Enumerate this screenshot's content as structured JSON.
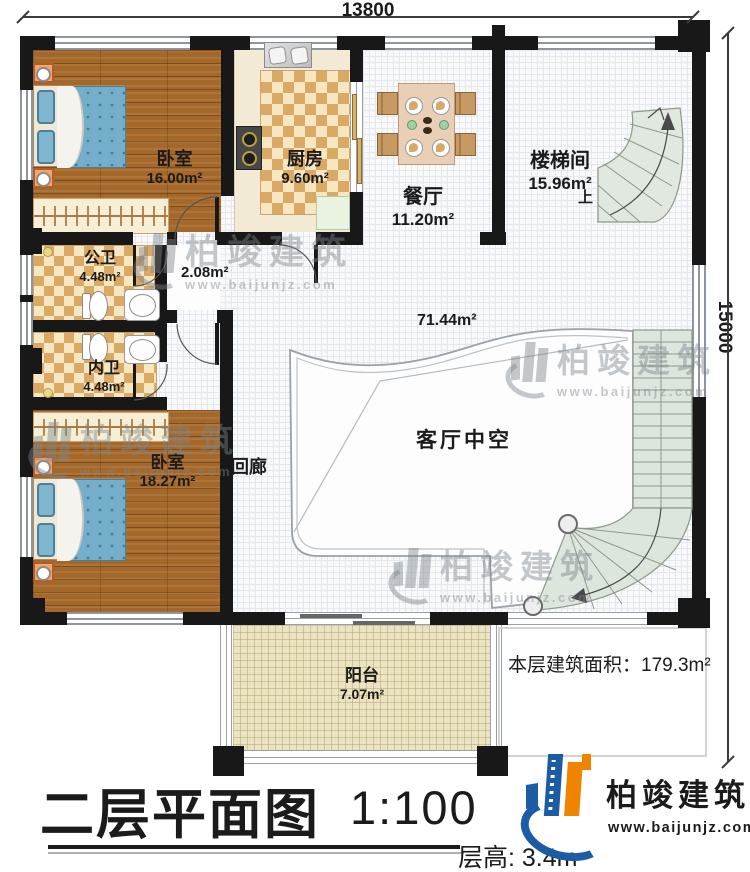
{
  "dimensions": {
    "width_label": "13800",
    "height_label": "15000"
  },
  "rooms": {
    "bedroom1": {
      "name": "卧室",
      "area": "16.00m²"
    },
    "kitchen": {
      "name": "厨房",
      "area": "9.60m²"
    },
    "dining": {
      "name": "餐厅",
      "area": "11.20m²"
    },
    "stairwell": {
      "name": "楼梯间",
      "area": "15.96m²"
    },
    "public_bath": {
      "name": "公卫",
      "area": "4.48m²"
    },
    "private_bath": {
      "name": "内卫",
      "area": "4.48m²"
    },
    "bedroom2": {
      "name": "卧室",
      "area": "18.27m²"
    },
    "balcony": {
      "name": "阳台",
      "area": "7.07m²"
    }
  },
  "labels": {
    "hall_area": "2.08m²",
    "void_area": "71.44m²",
    "void_name": "客厅中空",
    "corridor": "回廊",
    "stair_up": "上",
    "floor_area_note": "本层建筑面积：179.3m²",
    "floor_height": "层高: 3.4m"
  },
  "title": {
    "main": "二层平面图",
    "scale": "1:100"
  },
  "brand": {
    "name": "柏竣建筑",
    "url": "www.baijunjz.com"
  },
  "watermark": {
    "name": "柏竣建筑",
    "url": "www.baijunjz.com"
  },
  "colors": {
    "accent_blue": "#1b5ca4",
    "accent_orange": "#f08300",
    "wall": "#181818",
    "stair_fill": "#dde6dd",
    "wood": "#a4682b"
  }
}
